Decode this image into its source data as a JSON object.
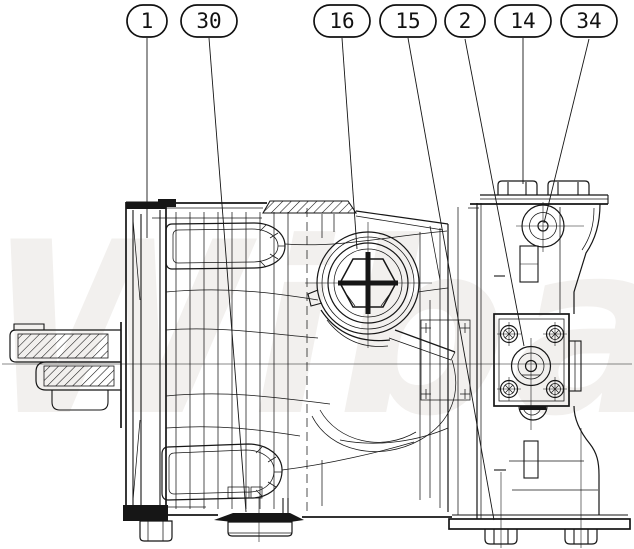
{
  "watermark": {
    "text": "Wibako",
    "color": "#f2f0ee"
  },
  "drawing": {
    "line_color": "#161616",
    "background": "#ffffff"
  },
  "callouts": [
    {
      "label": "1"
    },
    {
      "label": "30"
    },
    {
      "label": "16"
    },
    {
      "label": "15"
    },
    {
      "label": "2"
    },
    {
      "label": "14"
    },
    {
      "label": "34"
    }
  ]
}
